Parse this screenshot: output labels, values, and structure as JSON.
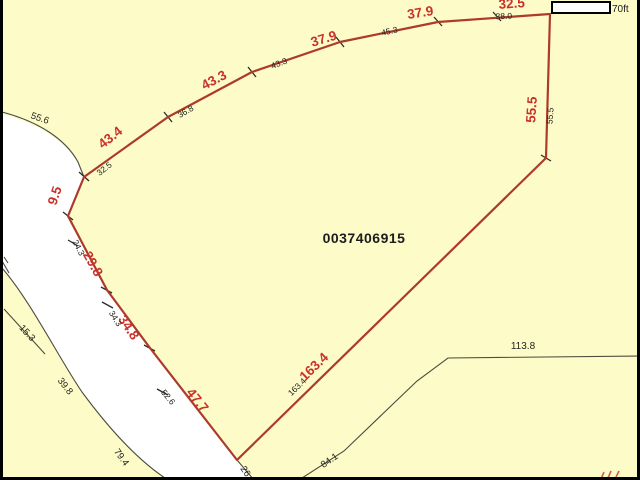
{
  "map": {
    "parcel_id": "0037406915",
    "scale_bar_label": "70ft",
    "colors": {
      "parcel_fill": "#fdfbc8",
      "road_fill": "#ffffff",
      "red_boundary": "#ad3a2b",
      "red_label": "#c9322a",
      "thin_line": "#4c4c40",
      "black_label": "#23231e",
      "frame": "#000000"
    },
    "red_labels": [
      {
        "text": "9.5",
        "x": 59,
        "y": 197,
        "rot": -72
      },
      {
        "text": "43.4",
        "x": 113,
        "y": 141,
        "rot": -38
      },
      {
        "text": "43.3",
        "x": 216,
        "y": 84,
        "rot": -28
      },
      {
        "text": "37.9",
        "x": 325,
        "y": 43,
        "rot": -17
      },
      {
        "text": "37.9",
        "x": 421,
        "y": 17,
        "rot": -9
      },
      {
        "text": "32.5",
        "x": 512,
        "y": 8,
        "rot": -4
      },
      {
        "text": "55.5",
        "x": 536,
        "y": 110,
        "rot": -86
      },
      {
        "text": "163.4",
        "x": 317,
        "y": 370,
        "rot": -44
      },
      {
        "text": "47.7",
        "x": 194,
        "y": 403,
        "rot": 51
      },
      {
        "text": "34.8",
        "x": 125,
        "y": 330,
        "rot": 56
      },
      {
        "text": "29.8",
        "x": 89,
        "y": 266,
        "rot": 61
      }
    ],
    "black_labels": [
      {
        "text": "55.6",
        "x": 39,
        "y": 121,
        "rot": 19,
        "size": 9.5
      },
      {
        "text": "32.5",
        "x": 106,
        "y": 171,
        "rot": -38,
        "size": 8.5
      },
      {
        "text": "36.8",
        "x": 187,
        "y": 114,
        "rot": -30,
        "size": 8.5
      },
      {
        "text": "43.3",
        "x": 280,
        "y": 66,
        "rot": -21,
        "size": 8.5
      },
      {
        "text": "45.3",
        "x": 390,
        "y": 34,
        "rot": -13,
        "size": 8.5
      },
      {
        "text": "38.0",
        "x": 504,
        "y": 19,
        "rot": -3,
        "size": 8.5
      },
      {
        "text": "55.5",
        "x": 553,
        "y": 116,
        "rot": -86,
        "size": 8.5
      },
      {
        "text": "24.3",
        "x": 76,
        "y": 249,
        "rot": 63,
        "size": 8.5
      },
      {
        "text": "34.3",
        "x": 113,
        "y": 320,
        "rot": 58,
        "size": 8.5
      },
      {
        "text": "52.6",
        "x": 166,
        "y": 399,
        "rot": 50,
        "size": 8.5
      },
      {
        "text": "163.4",
        "x": 299,
        "y": 389,
        "rot": -44,
        "size": 8.5
      },
      {
        "text": "26",
        "x": 243,
        "y": 473,
        "rot": 55,
        "size": 9.5
      },
      {
        "text": "84.1",
        "x": 331,
        "y": 463,
        "rot": -34,
        "size": 9.5
      },
      {
        "text": "113.8",
        "x": 523,
        "y": 349,
        "rot": 0,
        "size": 10
      },
      {
        "text": "15.3",
        "x": 25,
        "y": 335,
        "rot": 47,
        "size": 9.5
      },
      {
        "text": "39.8",
        "x": 63,
        "y": 388,
        "rot": 52,
        "size": 9.5
      },
      {
        "text": "79.4",
        "x": 119,
        "y": 459,
        "rot": 54,
        "size": 9.5
      }
    ]
  }
}
